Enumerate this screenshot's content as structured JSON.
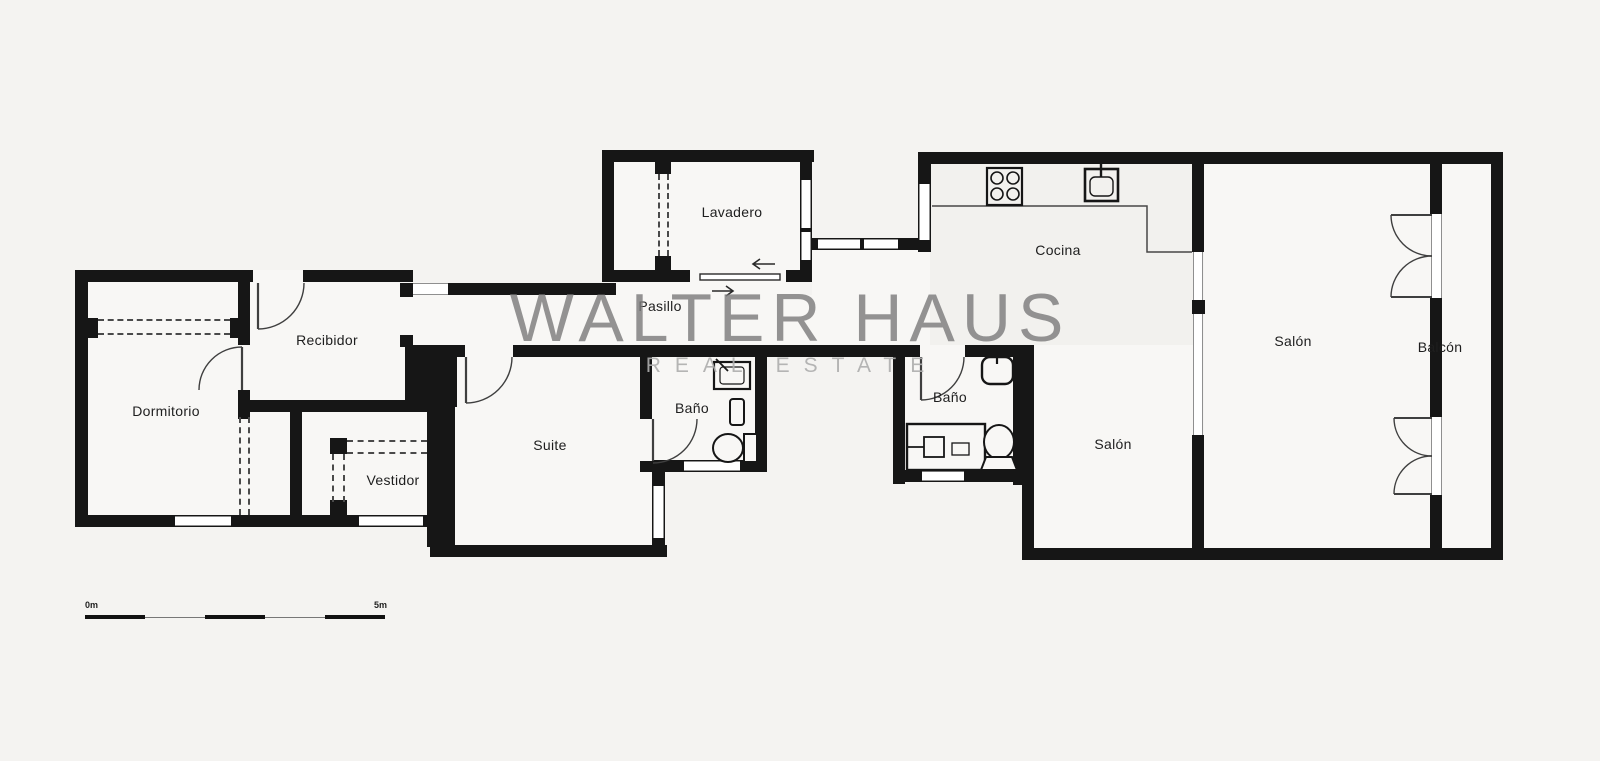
{
  "watermark": {
    "title": "WALTER HAUS",
    "subtitle": "REAL ESTATE"
  },
  "rooms": [
    {
      "id": "dormitorio",
      "label": "Dormitorio"
    },
    {
      "id": "recibidor",
      "label": "Recibidor"
    },
    {
      "id": "vestidor",
      "label": "Vestidor"
    },
    {
      "id": "suite",
      "label": "Suite"
    },
    {
      "id": "bano-suite",
      "label": "Baño"
    },
    {
      "id": "pasillo",
      "label": "Pasillo"
    },
    {
      "id": "lavadero",
      "label": "Lavadero"
    },
    {
      "id": "cocina",
      "label": "Cocina"
    },
    {
      "id": "bano-hall",
      "label": "Baño"
    },
    {
      "id": "salon-open",
      "label": "Salón"
    },
    {
      "id": "salon-main",
      "label": "Salón"
    },
    {
      "id": "balcon",
      "label": "Balcón"
    }
  ],
  "scale_bar": {
    "start_label": "0m",
    "end_label": "5m"
  },
  "colors": {
    "background": "#f4f3f1",
    "floor": "#f8f7f5",
    "kitchen_floor": "#f2f1ee",
    "wall": "#161616",
    "door_line": "#3f3f3f",
    "watermark": "#7d7d7d",
    "watermark_sub": "#aeaeae"
  }
}
